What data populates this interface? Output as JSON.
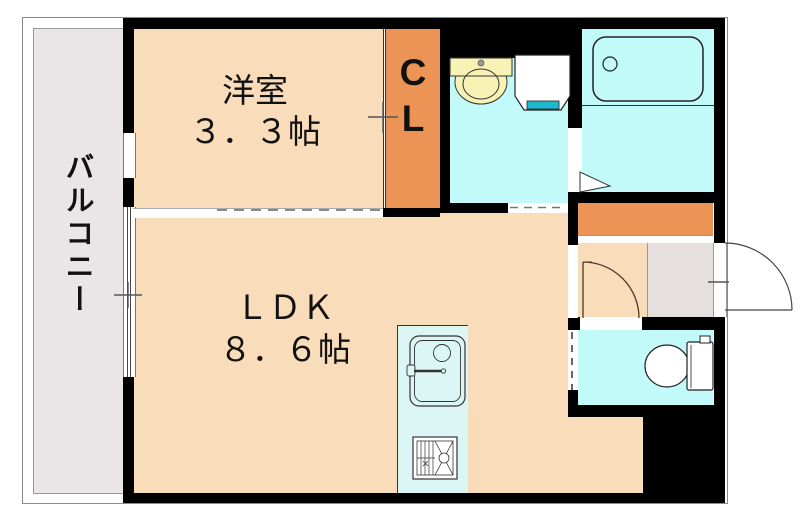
{
  "floorplan": {
    "kind": "japanese-apartment-floor-plan",
    "rooms": {
      "balcony": {
        "label": "バルコニー"
      },
      "western_room": {
        "label": "洋室",
        "size": "３．３帖"
      },
      "ldk": {
        "label": "ＬＤＫ",
        "size": "８．６帖"
      },
      "closet": {
        "label_line1": "C",
        "label_line2": "L"
      },
      "washroom": {
        "label": ""
      },
      "bathroom": {
        "label": ""
      },
      "toilet": {
        "label": ""
      },
      "entrance": {
        "label": ""
      }
    },
    "fixtures": [
      "wash-basin",
      "washing-machine-pan",
      "bathtub",
      "toilet-bowl",
      "kitchen-sink",
      "gas-stove",
      "shoe-cabinet",
      "entrance-door-swing",
      "interior-door-swing",
      "bathroom-door-triangle",
      "sliding-door-western-room",
      "sliding-door-washroom",
      "closet-sliding-door",
      "window-western-room",
      "window-ldk"
    ],
    "colors": {
      "wall": "#000000",
      "room_floor_peach": "#f9dcba",
      "closet_orange": "#ec9455",
      "wet_area_cyan": "#c2fafa",
      "kitchen_counter_cyan": "#dcf5f5",
      "balcony_gray": "#eae6e8",
      "entrance_gray": "#e5e0dd",
      "basin_yellow": "#f8f3b4",
      "washer_pan_teal": "#1fb9ce"
    }
  }
}
